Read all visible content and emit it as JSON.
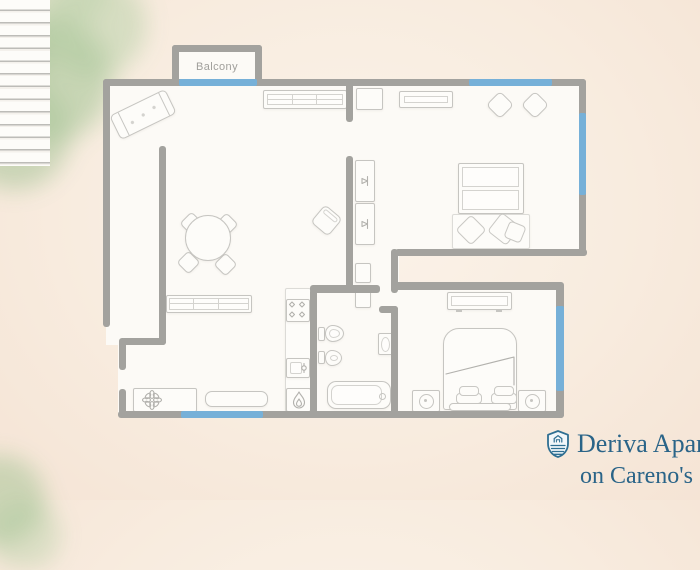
{
  "canvas": {
    "width": 700,
    "height": 500,
    "background_color": "#f8ecdf"
  },
  "decor": {
    "foliage_color": "#9cc18f",
    "foliage_spots": [
      "top-left",
      "bottom-left"
    ]
  },
  "floorplan": {
    "wall_color": "#a3a29e",
    "window_color": "#76b0d8",
    "floor_color": "#fcfaf6",
    "balcony_label": "Balcony",
    "rooms": [
      "balcony",
      "living-room",
      "bedroom-1",
      "hallway",
      "bathroom",
      "kitchen",
      "bedroom-2",
      "staircase"
    ],
    "furniture_icons": [
      "sofa-icon",
      "tv-cabinet-icon",
      "dining-table-icon",
      "dining-chair-icon",
      "armchair-icon",
      "sideboard-icon",
      "stairs-icon",
      "flower-cabinet-icon",
      "counter-icon",
      "stove-icon",
      "kitchen-sink-icon",
      "boiler-flame-icon",
      "side-table-icon",
      "tv-panel-icon",
      "pouf-icon",
      "wardrobe-hanger-icon",
      "bed-icon",
      "pillow-icon",
      "toilet-icon",
      "bidet-icon",
      "washbasin-icon",
      "bathtub-icon",
      "dresser-icon",
      "nightstand-lamp-icon"
    ]
  },
  "branding": {
    "logo_icon": "shield-crest-icon",
    "line1": "Deriva Apar",
    "line2": "on Careno's",
    "text_color": "#2a6488"
  }
}
